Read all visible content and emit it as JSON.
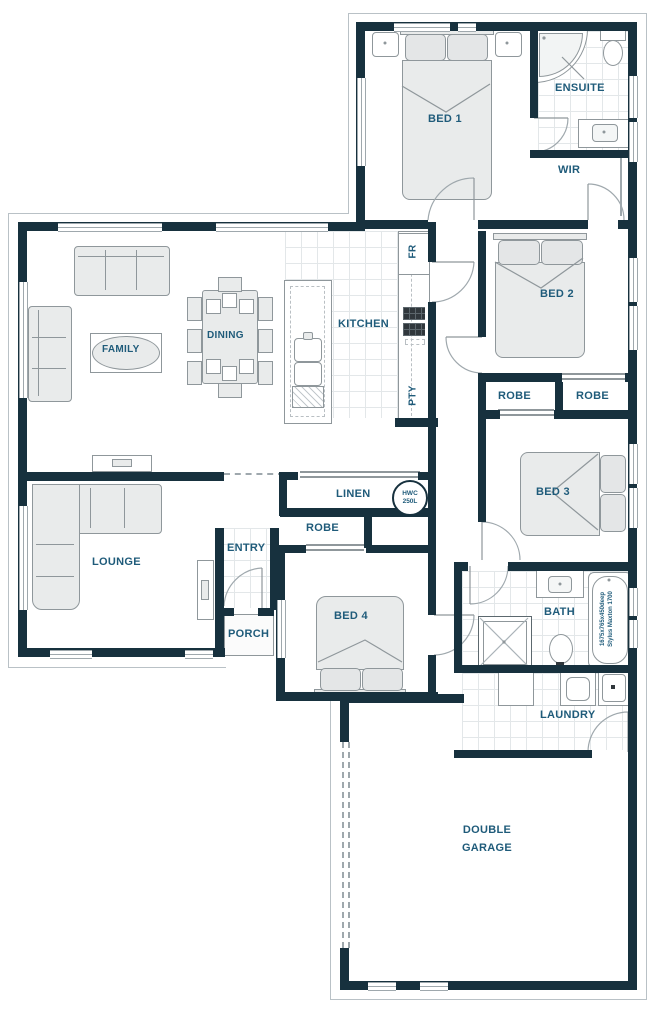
{
  "meta": {
    "type": "residential floor plan",
    "style": "architectural line drawing"
  },
  "colors": {
    "wall": "#17313e",
    "label_text": "#1f5b7a",
    "furniture_fill": "#e9ebeb",
    "line": "#8f979b"
  },
  "rooms": {
    "bed1": "BED 1",
    "ensuite": "ENSUITE",
    "wir": "WIR",
    "family": "FAMILY",
    "dining": "DINING",
    "kitchen": "KITCHEN",
    "fridge": "FR",
    "pantry": "PTY",
    "bed2": "BED 2",
    "robe_bed2": "ROBE",
    "robe_bed3": "ROBE",
    "bed3": "BED 3",
    "linen": "LINEN",
    "robe_bed4": "ROBE",
    "lounge": "LOUNGE",
    "entry": "ENTRY",
    "porch": "PORCH",
    "bed4": "BED 4",
    "bath": "BATH",
    "laundry": "LAUNDRY",
    "garage_line1": "DOUBLE",
    "garage_line2": "GARAGE"
  },
  "fixtures": {
    "hwc_line1": "HWC",
    "hwc_line2": "250L",
    "tub_spec_line1": "1675x765x450deep",
    "tub_spec_line2": "Stylus Maxton 1700"
  }
}
